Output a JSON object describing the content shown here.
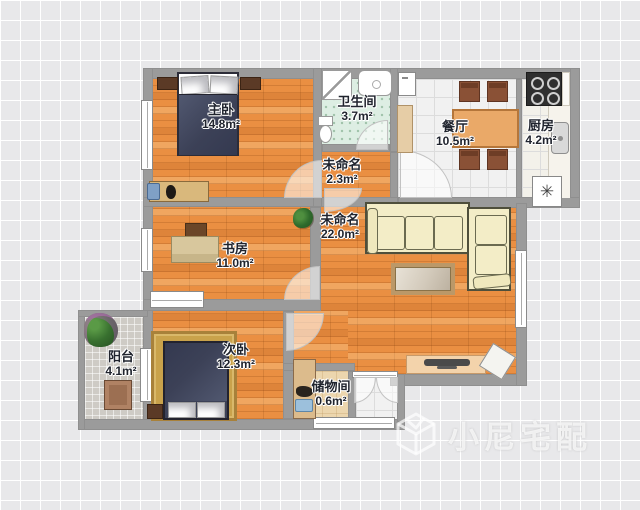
{
  "watermark": {
    "text": "小尼宅配",
    "logo": "cube-logo"
  },
  "rooms": [
    {
      "id": "master-bedroom",
      "name": "主卧",
      "area": "14.8m²"
    },
    {
      "id": "bathroom",
      "name": "卫生间",
      "area": "3.7m²"
    },
    {
      "id": "hallway",
      "name": "未命名",
      "area": "2.3m²"
    },
    {
      "id": "dining-room",
      "name": "餐厅",
      "area": "10.5m²"
    },
    {
      "id": "kitchen",
      "name": "厨房",
      "area": "4.2m²"
    },
    {
      "id": "study",
      "name": "书房",
      "area": "11.0m²"
    },
    {
      "id": "living-room",
      "name": "未命名",
      "area": "22.0m²"
    },
    {
      "id": "balcony",
      "name": "阳台",
      "area": "4.1m²"
    },
    {
      "id": "second-bedroom",
      "name": "次卧",
      "area": "12.3m²"
    },
    {
      "id": "storage-room",
      "name": "储物间",
      "area": "0.6m²"
    }
  ],
  "symbols": {
    "washer": "✳"
  },
  "colors": {
    "floor_wood": "#ea8f42",
    "wall": "#9b9b9b",
    "bath_tile": "#ddeee3",
    "sofa": "#f3edc7",
    "bed": "#3c4157",
    "grid_bg": "#e8e8ea"
  }
}
